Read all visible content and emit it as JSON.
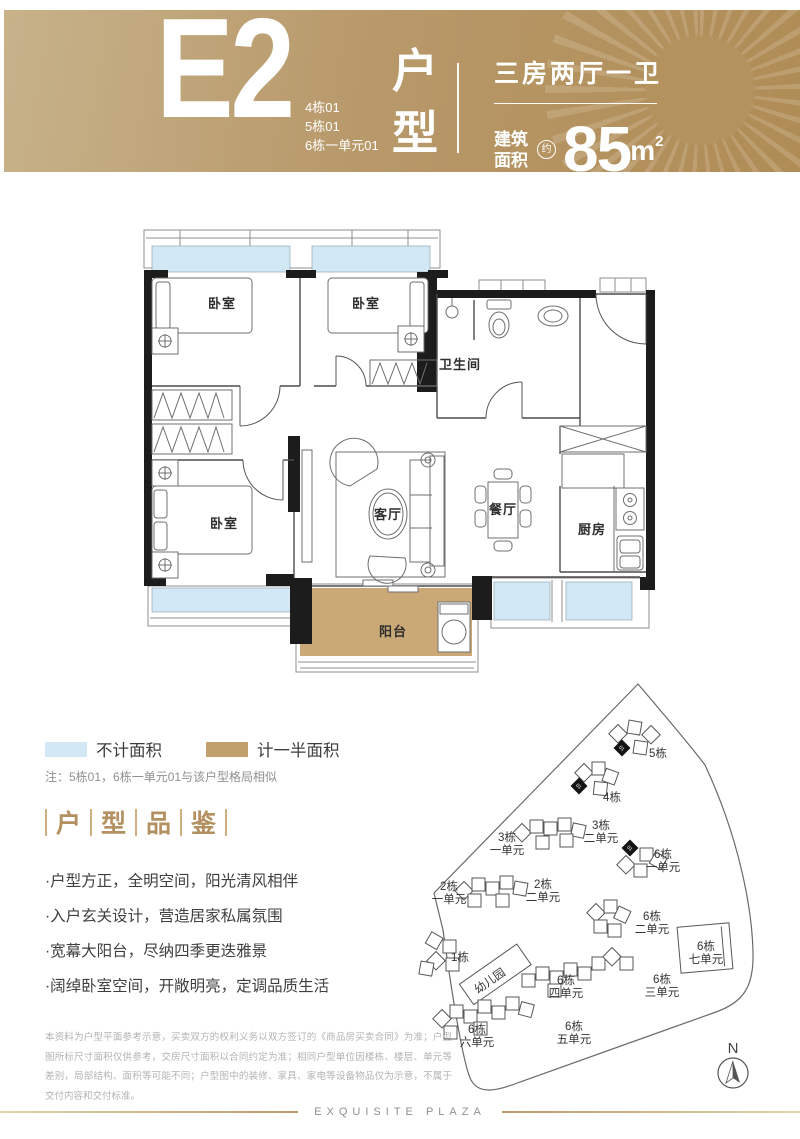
{
  "header": {
    "unit_code": "E2",
    "building_units": [
      "4栋01",
      "5栋01",
      "6栋一单元01"
    ],
    "type_chars": [
      "户",
      "型"
    ],
    "layout_summary": "三房两厅一卫",
    "area_label": [
      "建筑",
      "面积"
    ],
    "area_approx": "约",
    "area_value": "85",
    "area_unit": "m",
    "area_exp": "2"
  },
  "floorplan": {
    "labels": {
      "bedroom": "卧室",
      "bathroom": "卫生间",
      "living": "客厅",
      "dining": "餐厅",
      "kitchen": "厨房",
      "balcony": "阳台"
    }
  },
  "legend": {
    "excluded": "不计面积",
    "half": "计一半面积"
  },
  "note": "注：5栋01，6栋一单元01与该户型格局相似",
  "section_title": {
    "chars": [
      "户",
      "型",
      "品",
      "鉴"
    ]
  },
  "features": [
    "户型方正，全明空间，阳光清风相伴",
    "入户玄关设计，营造居家私属氛围",
    "宽幕大阳台，尽纳四季更迭雅景",
    "阔绰卧室空间，开敞明亮，定调品质生活"
  ],
  "sitemap": {
    "unit_marker": "01",
    "compass": "N",
    "labels": [
      {
        "l1": "5栋"
      },
      {
        "l1": "4栋"
      },
      {
        "l1": "3栋",
        "l2": "一单元"
      },
      {
        "l1": "3栋",
        "l2": "二单元"
      },
      {
        "l1": "6栋",
        "l2": "一单元"
      },
      {
        "l1": "2栋",
        "l2": "一单元"
      },
      {
        "l1": "2栋",
        "l2": "二单元"
      },
      {
        "l1": "6栋",
        "l2": "二单元"
      },
      {
        "l1": "6栋",
        "l2": "七单元"
      },
      {
        "l1": "1栋"
      },
      {
        "l1": "幼儿园"
      },
      {
        "l1": "6栋",
        "l2": "四单元"
      },
      {
        "l1": "6栋",
        "l2": "三单元"
      },
      {
        "l1": "6栋",
        "l2": "六单元"
      },
      {
        "l1": "6栋",
        "l2": "五单元"
      }
    ]
  },
  "disclaimer": "本资料为户型平面参考示意，买卖双方的权利义务以双方签订的《商品房买卖合同》为准；户型图所标尺寸面积仅供参考，交房尺寸面积以合同约定为准；相同户型单位因楼栋、楼层、单元等差别，局部结构、面积等可能不同；户型图中的装修、家具、家电等设备物品仅为示意，不属于交付内容和交付标准。",
  "footer": {
    "brand": "EXQUISITE PLAZA"
  },
  "colors": {
    "gold_dark": "#b08c55",
    "gold_light": "#c7b28b",
    "accent_gold": "#b3905f",
    "window_blue": "#d3e8f5",
    "half_area_tan": "#c9a976"
  }
}
